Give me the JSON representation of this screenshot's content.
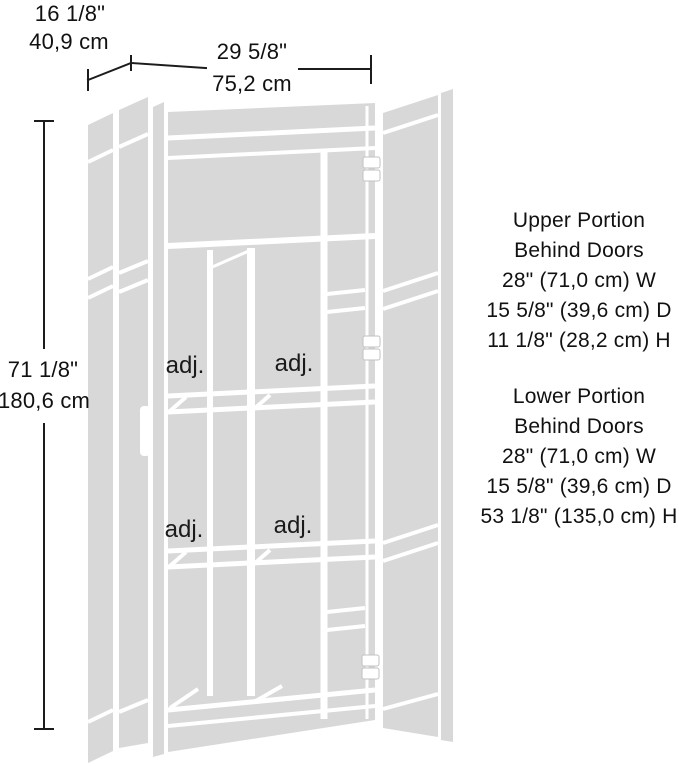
{
  "diagram": {
    "overall": {
      "depth_in": "16 1/8\"",
      "depth_cm": "40,9 cm",
      "width_in": "29 5/8\"",
      "width_cm": "75,2 cm",
      "height_in": "71 1/8\"",
      "height_cm": "180,6 cm"
    },
    "upper_portion": {
      "line1": "Upper Portion",
      "line2": "Behind Doors",
      "width": "28\" (71,0 cm) W",
      "depth": "15 5/8\" (39,6 cm) D",
      "height": "11 1/8\" (28,2 cm) H"
    },
    "lower_portion": {
      "line1": "Lower Portion",
      "line2": "Behind Doors",
      "width": "28\" (71,0 cm) W",
      "depth": "15 5/8\" (39,6 cm) D",
      "height": "53 1/8\" (135,0 cm) H"
    },
    "shelf_labels": {
      "upper_left": "adj.",
      "upper_right": "adj.",
      "lower_left": "adj.",
      "lower_right": "adj."
    },
    "colors": {
      "line_art_fill": "#d8d8d8",
      "dimension_line": "#1c1c1c",
      "text": "#111111",
      "background": "#ffffff"
    }
  }
}
